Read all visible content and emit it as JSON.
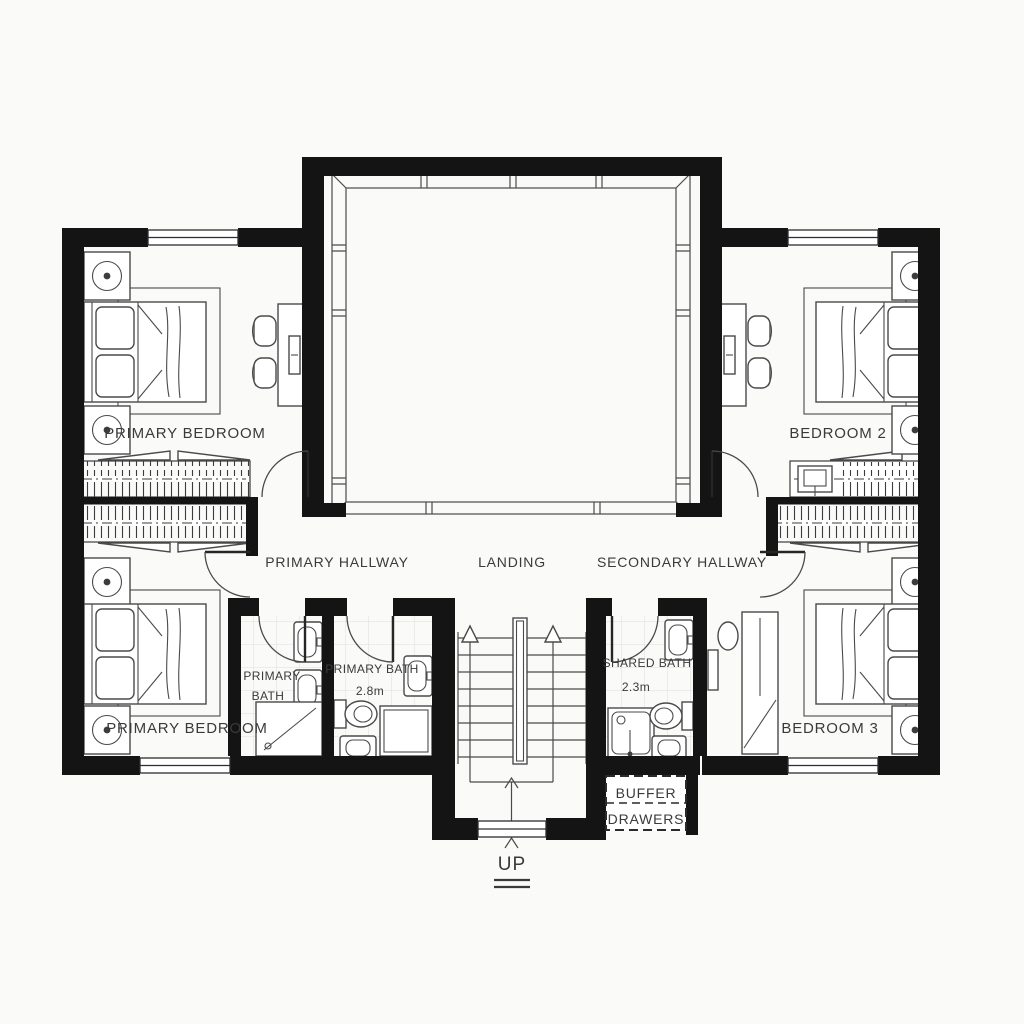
{
  "document_type": "floor-plan",
  "colors": {
    "wall": "#141414",
    "line": "#4a4a4a",
    "text": "#3a3a3a",
    "background": "#fafaf9"
  },
  "labels": {
    "bedroom_top_left": "PRIMARY BEDROOM",
    "bedroom_top_right": "BEDROOM 2",
    "bedroom_bottom_left": "PRIMARY BEDROOM",
    "bedroom_bottom_right": "BEDROOM 3",
    "hallway_primary": "PRIMARY HALLWAY",
    "landing": "LANDING",
    "hallway_secondary": "SECONDARY HALLWAY",
    "bath_primary_small": {
      "line1": "PRIMARY",
      "line2": "BATH"
    },
    "bath_primary_main": {
      "line1": "PRIMARY BATH",
      "line2": "2.8m"
    },
    "bath_shared": {
      "line1": "SHARED BATH",
      "line2": "2.3m"
    },
    "buffer": {
      "line1": "BUFFER",
      "line2": "DRAWERS"
    },
    "stairs_up": "UP"
  }
}
